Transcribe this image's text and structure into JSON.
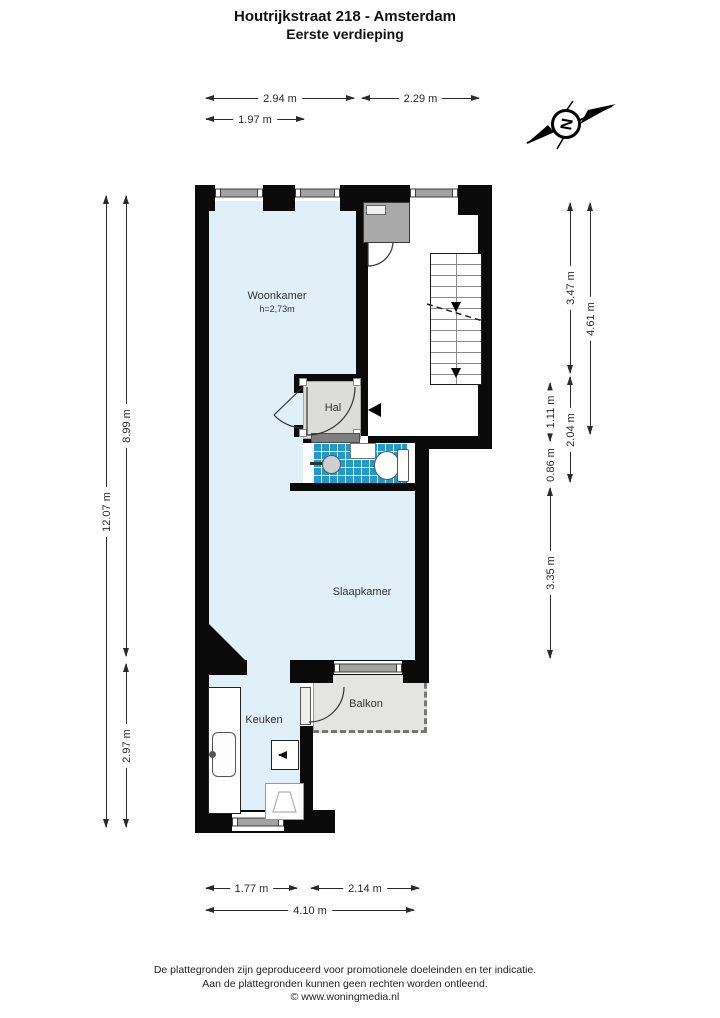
{
  "title": {
    "line1": "Houtrijkstraat 218 - Amsterdam",
    "line2": "Eerste verdieping"
  },
  "compass": {
    "letter": "N"
  },
  "rooms": {
    "woonkamer": {
      "name": "Woonkamer",
      "ceiling_height": "h=2,73m"
    },
    "hal": {
      "name": "Hal"
    },
    "slaapkamer": {
      "name": "Slaapkamer"
    },
    "keuken": {
      "name": "Keuken"
    },
    "balkon": {
      "name": "Balkon"
    }
  },
  "dimensions": {
    "top": [
      {
        "label": "2.94 m"
      },
      {
        "label": "2.29 m"
      },
      {
        "label": "1.97 m"
      }
    ],
    "left": [
      {
        "label": "12.07 m"
      },
      {
        "label": "8.99 m"
      },
      {
        "label": "2.97 m"
      }
    ],
    "right": [
      {
        "label": "3.47 m"
      },
      {
        "label": "4.61 m"
      },
      {
        "label": "1.11 m"
      },
      {
        "label": "0.86 m"
      },
      {
        "label": "2.04 m"
      },
      {
        "label": "3.35 m"
      }
    ],
    "bottom": [
      {
        "label": "1.77 m"
      },
      {
        "label": "2.14 m"
      },
      {
        "label": "4.10 m"
      }
    ]
  },
  "footer": {
    "line1": "De plattegronden zijn geproduceerd voor promotionele doeleinden en ter indicatie.",
    "line2": "Aan de plattegronden kunnen geen rechten worden ontleend.",
    "line3": "© www.woningmedia.nl"
  },
  "icons": {
    "compass": "compass-north-arrow",
    "entry": "entrance-arrow",
    "stairs": "stairs-down"
  },
  "colors": {
    "wall": "#0a0a0a",
    "room_fill": "#e1eff8",
    "hal_floor": "#dcdcda",
    "balkon_floor": "#e4e4e2",
    "tile_blue": "#2499cd",
    "window_bar": "#a2a2a2",
    "cabinet_gray": "#a9a9a9"
  }
}
